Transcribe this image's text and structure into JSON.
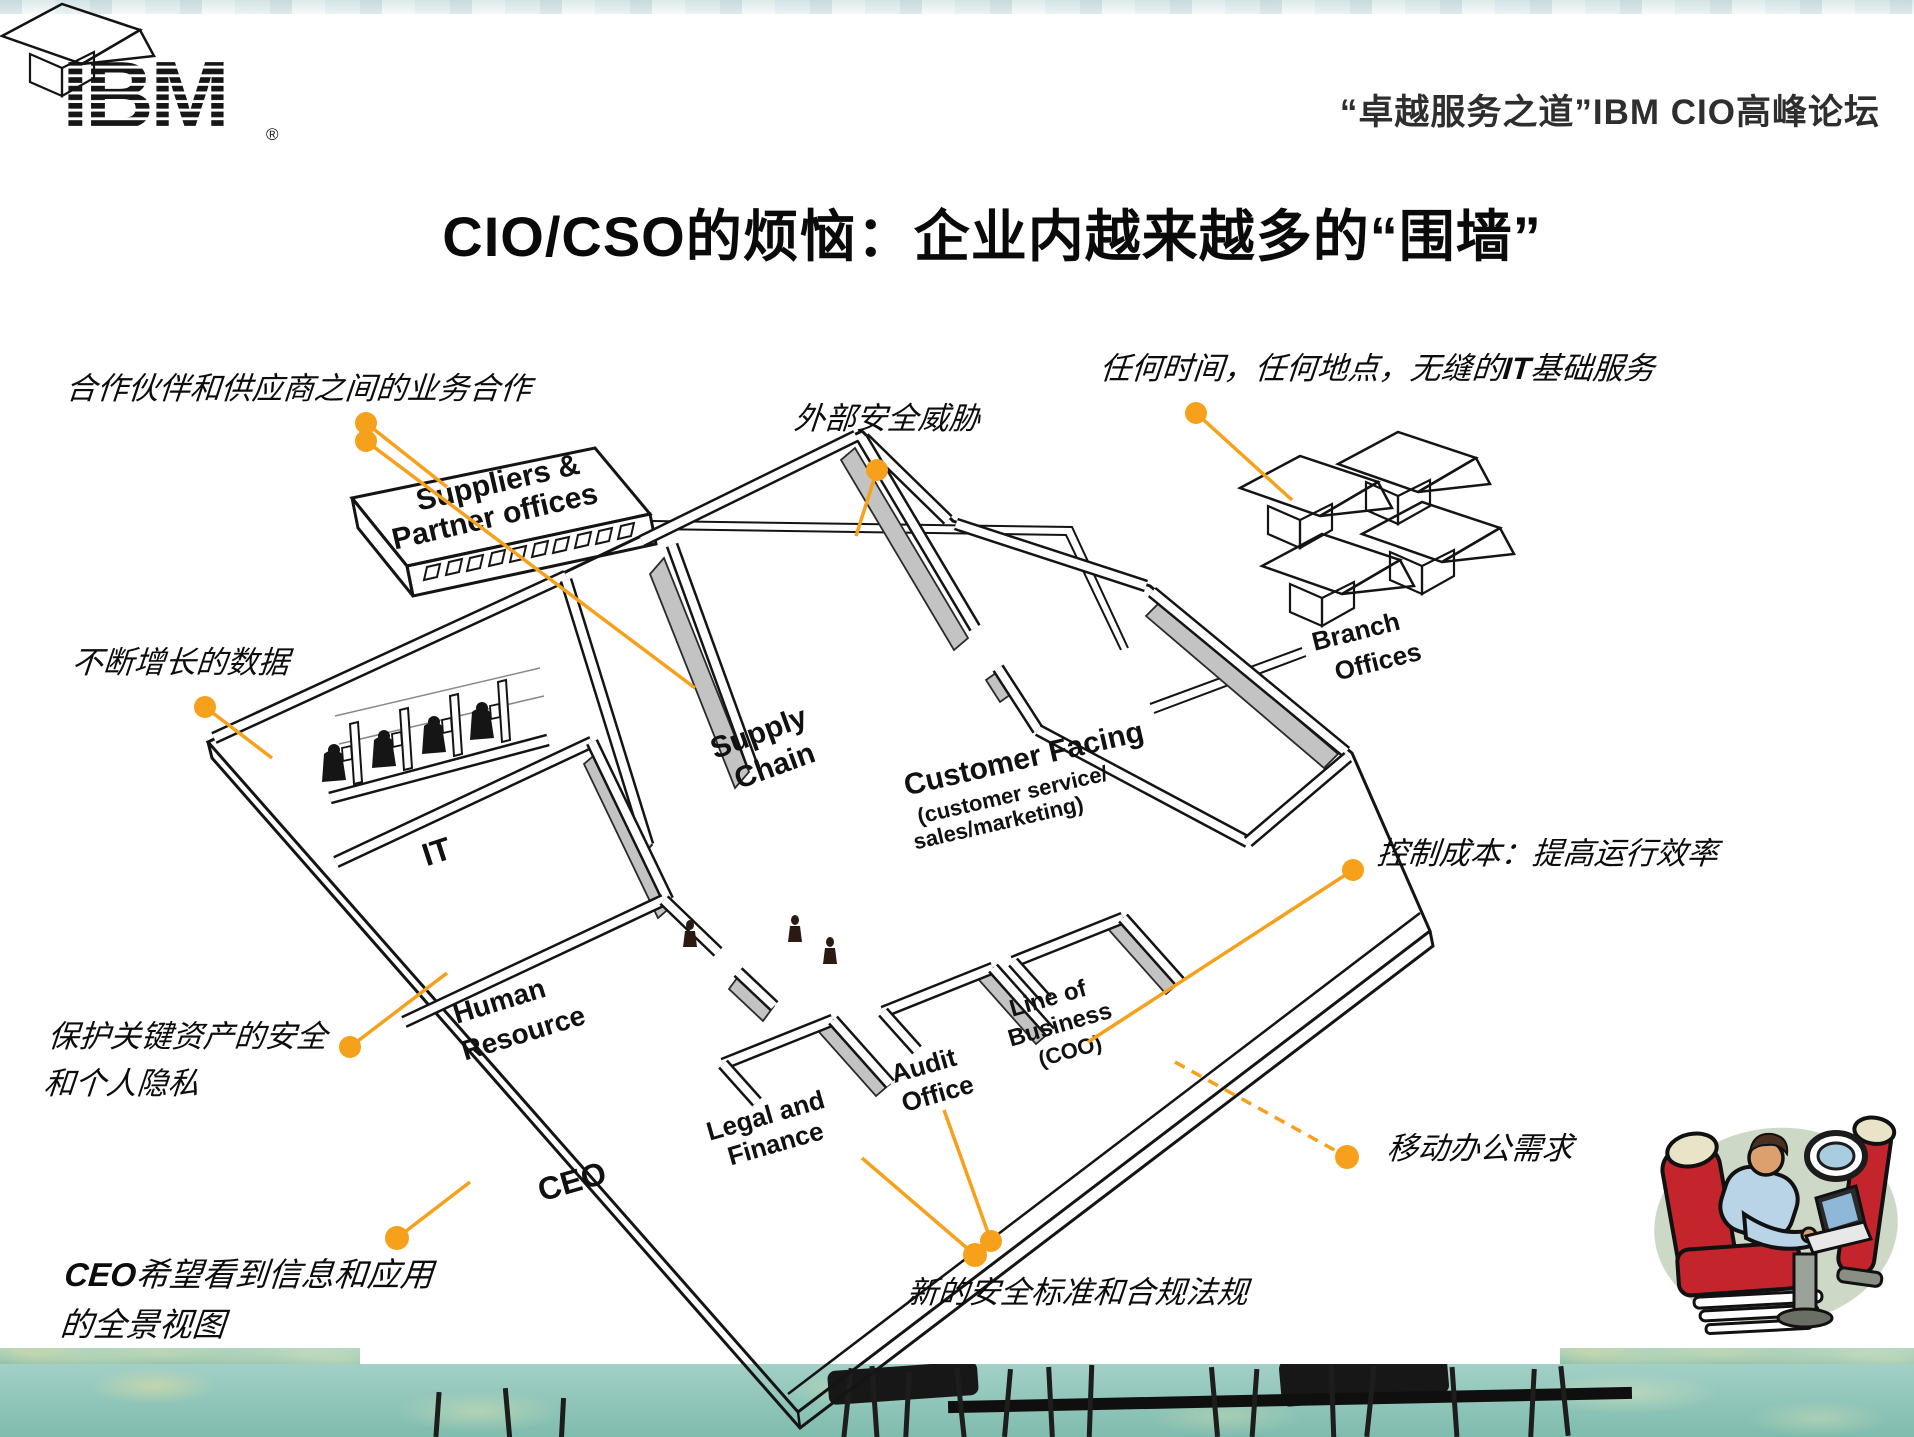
{
  "slide": {
    "logo_text": "IBM",
    "registered_mark": "®",
    "header_right": "“卓越服务之道”IBM CIO高峰论坛",
    "title": "CIO/CSO的烦恼：企业内越来越多的“围墙”"
  },
  "annotations": {
    "partner_collab": "合作伙伴和供应商之间的业务合作",
    "external_threat": "外部安全威胁",
    "anytime_prefix": "任何时间，任何地点，无缝的",
    "anytime_it": "IT",
    "anytime_suffix": "基础服务",
    "growing_data": "不断增长的数据",
    "protect_assets_line1": "保护关键资产的安全",
    "protect_assets_line2": "和个人隐私",
    "ceo_prefix": "CEO",
    "ceo_view_line1": "希望看到信息和应用",
    "ceo_view_line2": "的全景视图",
    "new_compliance": "新的安全标准和合规法规",
    "control_cost": "控制成本：提高运行效率",
    "mobile_office": "移动办公需求"
  },
  "diagram": {
    "suppliers_line1": "Suppliers &",
    "suppliers_line2": "Partner offices",
    "supply_line1": "Supply",
    "supply_line2": "Chain",
    "customer_main": "Customer Facing",
    "customer_sub1": "(customer service/",
    "customer_sub2": "sales/marketing)",
    "it_label": "IT",
    "hr_line1": "Human",
    "hr_line2": "Resource",
    "ceo_label": "CEO",
    "legal_line1": "Legal and",
    "legal_line2": "Finance",
    "audit_line1": "Audit",
    "audit_line2": "Office",
    "lob_line1": "Line of",
    "lob_line2": "Business",
    "lob_line3": "(COO)",
    "branch_line1": "Branch",
    "branch_line2": "Offices"
  },
  "colors": {
    "callout_orange": "#F7A01B",
    "wall_gray": "#c3c3c3",
    "strip_teal": "#7fbcae"
  }
}
